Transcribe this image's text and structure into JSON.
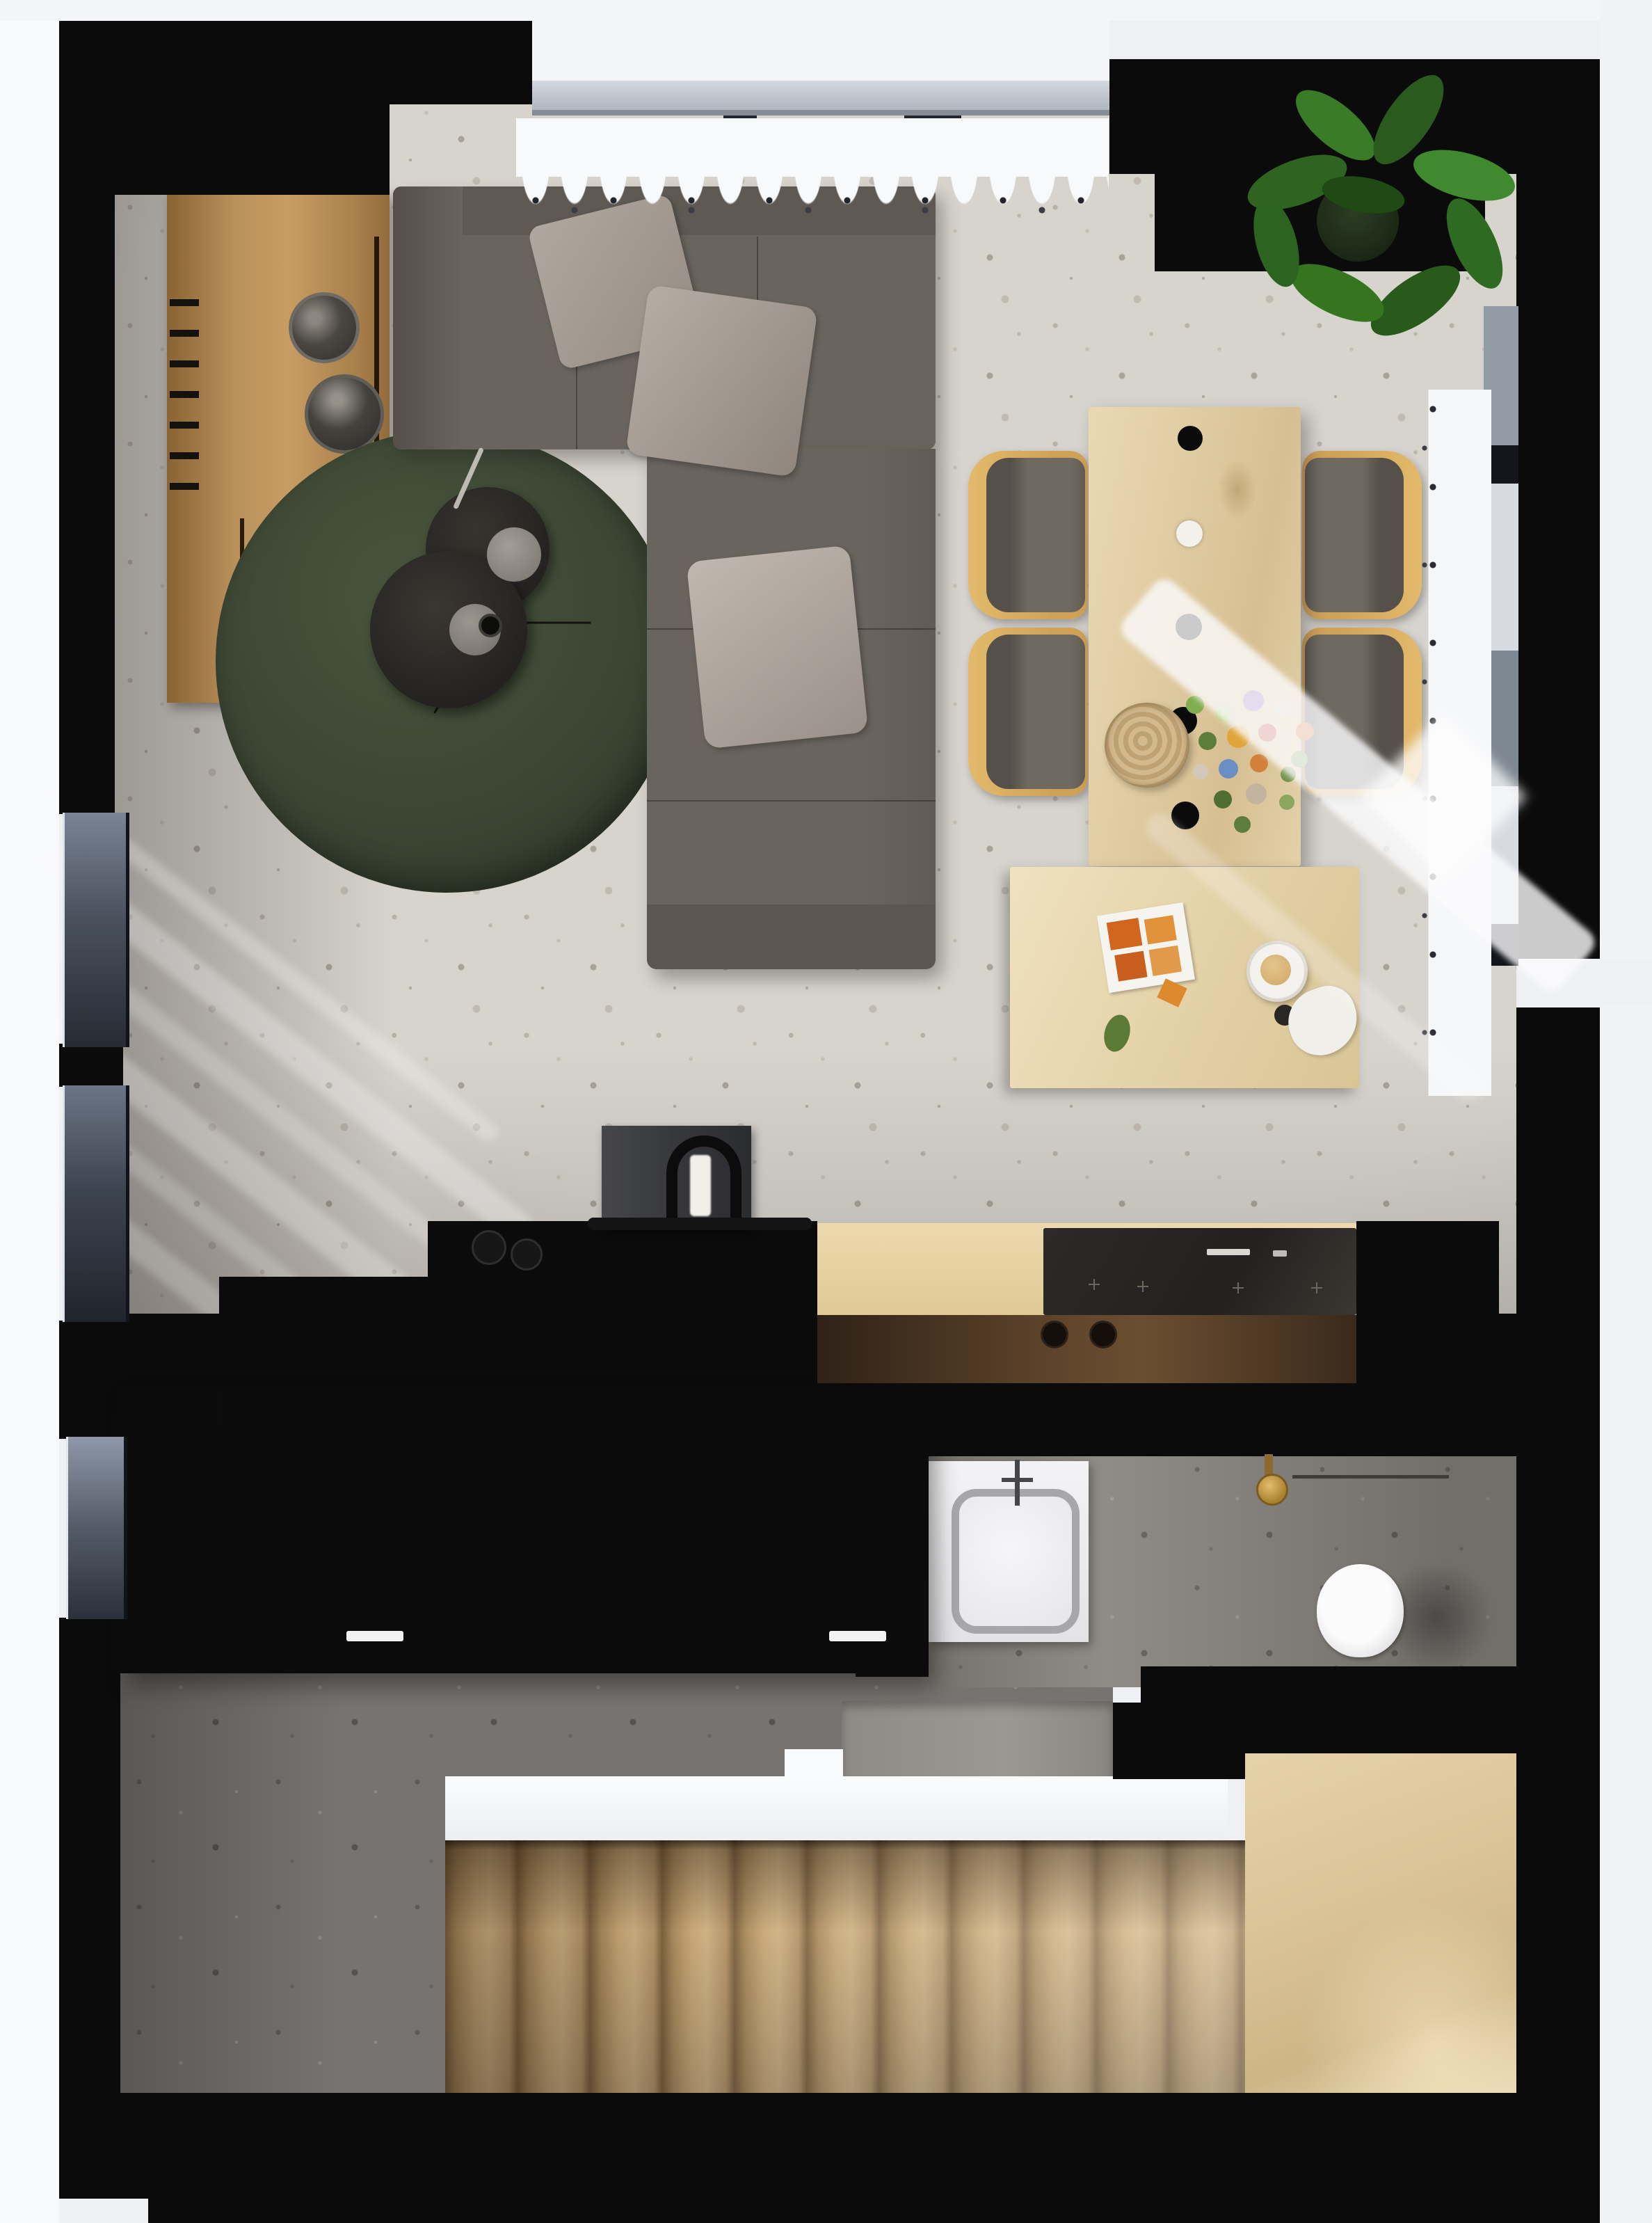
{
  "scene": {
    "title": "apartment-floor-plan-top-down-render",
    "type": "3d-rendered-floor-plan",
    "view": "top-down",
    "rooms": [
      {
        "name": "living-room",
        "floor": "light-terrazzo",
        "items": [
          "wood-sideboard",
          "sectional-sofa",
          "throw-pillows",
          "round-green-rug",
          "nesting-coffee-tables",
          "dining-table",
          "four-dining-chairs",
          "pendant-lamps",
          "flower-bouquet",
          "woven-bowl",
          "side-table",
          "potted-plant",
          "sheer-curtains",
          "sunlight-streaks"
        ]
      },
      {
        "name": "kitchen",
        "floor": "dark-wood-strip",
        "items": [
          "black-counter",
          "black-island",
          "island-handles",
          "cooktop-panel",
          "control-knobs",
          "counter-appliance",
          "bottles"
        ]
      },
      {
        "name": "hallway",
        "floor": "dark-terrazzo",
        "items": []
      },
      {
        "name": "bathroom",
        "floor": "mid-terrazzo",
        "items": [
          "washbasin-vanity",
          "basin-faucet",
          "wall-mounted-gold-faucet",
          "toilet"
        ]
      },
      {
        "name": "staircase",
        "items": [
          "white-landing-strip",
          "wood-treads",
          "wood-platform"
        ]
      }
    ],
    "palette": {
      "wall_black": "#0b0b0b",
      "living_floor": "#d7d3cd",
      "hall_floor": "#767370",
      "bath_floor": "#8f8b86",
      "wood_light": "#dcc49c",
      "wood_sideboard": "#b98e54",
      "stair_tread": "#bb9a6c",
      "rug_green": "#3e4734",
      "sofa_gray": "#6a645e",
      "chair_wood": "#d9ae62",
      "plant_green": "#35751f",
      "curtain_white": "#f7f8fa",
      "gold_fixture": "#bb9340",
      "exterior": "#eef0f4"
    }
  }
}
